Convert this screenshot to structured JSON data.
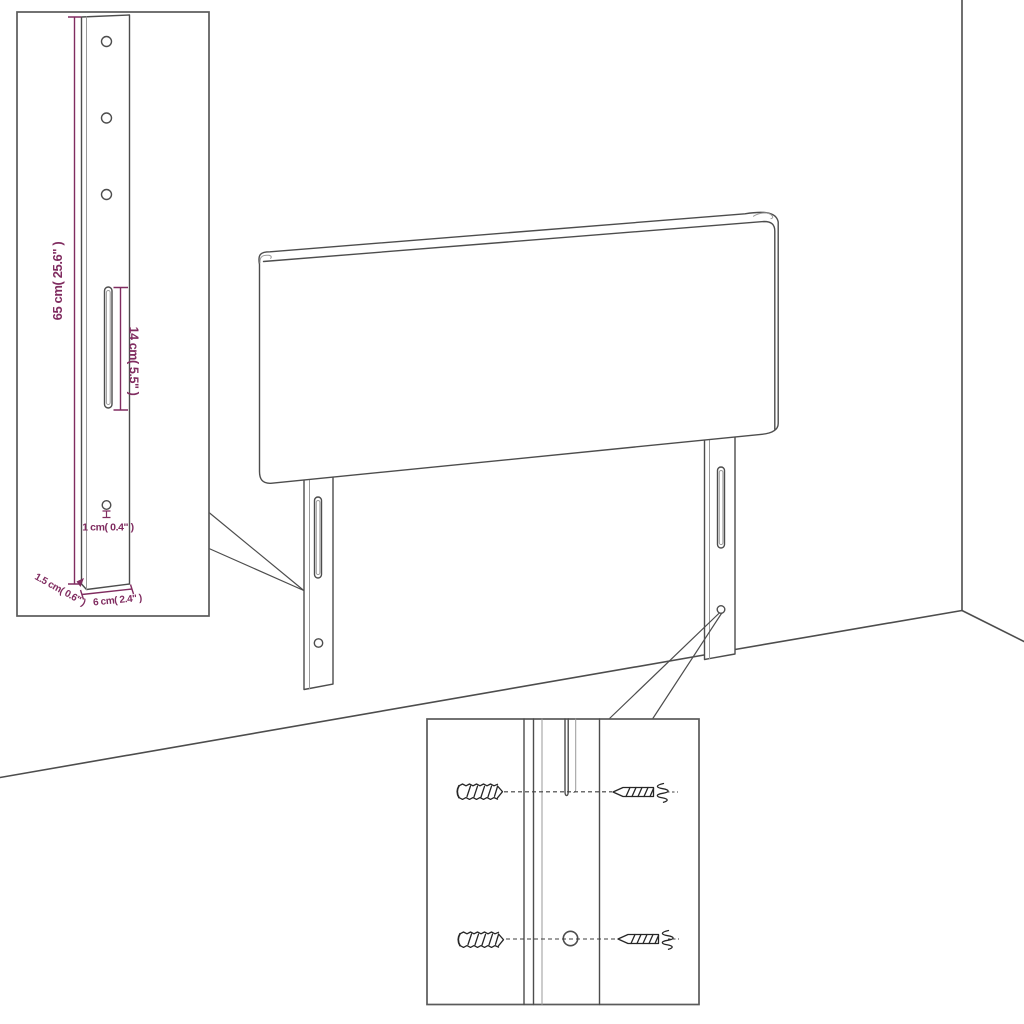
{
  "illustration": {
    "type": "product-assembly-diagram",
    "subject": "upholstered headboard with two slotted mounting legs, wall-fixing detail insets",
    "colors": {
      "background": "#ffffff",
      "outline": "#4d4d4d",
      "dimension_text": "#802c60",
      "hardware_sketch": "#262626"
    },
    "leg_detail_inset": {
      "dim_height": "65 cm( 25.6\" )",
      "dim_slot": "14 cm( 5.5\" )",
      "dim_hole": "1 cm( 0.4\" )",
      "dim_thickness": "1.5 cm( 0.6\" )",
      "dim_width": "6 cm( 2.4\" )"
    },
    "hardware_inset": {
      "wall_plugs": "2",
      "screws": "2"
    }
  }
}
